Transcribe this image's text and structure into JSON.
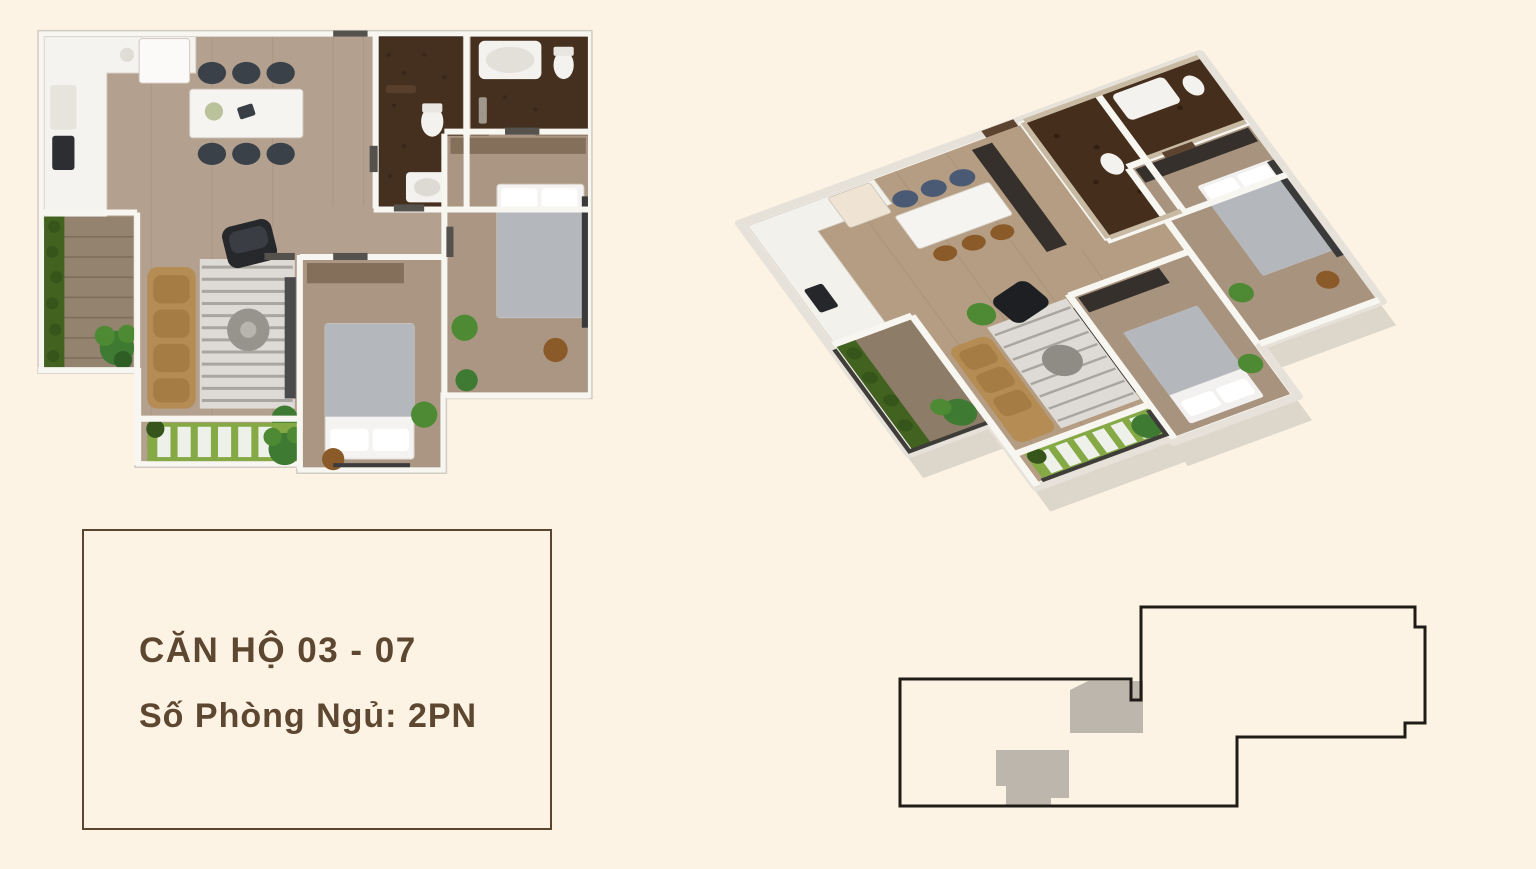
{
  "page": {
    "background_color": "#fdf3e5",
    "description_visible_elements": "2D floor plan, 3D isometric floor plan, unit info card, building key plan"
  },
  "info_card": {
    "title": "CĂN HỘ 03 - 07",
    "subtitle": "Số Phòng Ngủ: 2PN",
    "text_color": "#5d4730",
    "border_color": "#5a452e"
  },
  "figures": {
    "floorplan_2d": {
      "label": "2d-top-down-apartment-floor-plan",
      "rooms": [
        "kitchen-dining",
        "bathroom-1",
        "bathroom-2",
        "living-room",
        "bedroom-1",
        "bedroom-2",
        "left-balcony",
        "bottom-balcony"
      ]
    },
    "floorplan_3d": {
      "label": "3d-isometric-apartment-cutaway",
      "rooms": [
        "kitchen-dining",
        "bathroom-1",
        "bathroom-2",
        "living-room",
        "bedroom-1",
        "bedroom-2",
        "left-balcony",
        "bottom-balcony"
      ]
    },
    "keyplan": {
      "label": "building-floor-key-plan",
      "outline_color": "#1f1c17",
      "unit_marker_color": "#bcb6ac",
      "unit_markers": 2
    }
  },
  "palette": {
    "wall_white": "#f8f6f1",
    "wood_floor": "#b3a08e",
    "bedroom_floor": "#aa9683",
    "bathroom_tile": "#45301f",
    "sofa_tan": "#b58c53",
    "plant_green": "#4e8a33",
    "grass_green": "#85a944",
    "blanket_gray": "#b4b7bc",
    "shadow": "#dcd6cb"
  }
}
